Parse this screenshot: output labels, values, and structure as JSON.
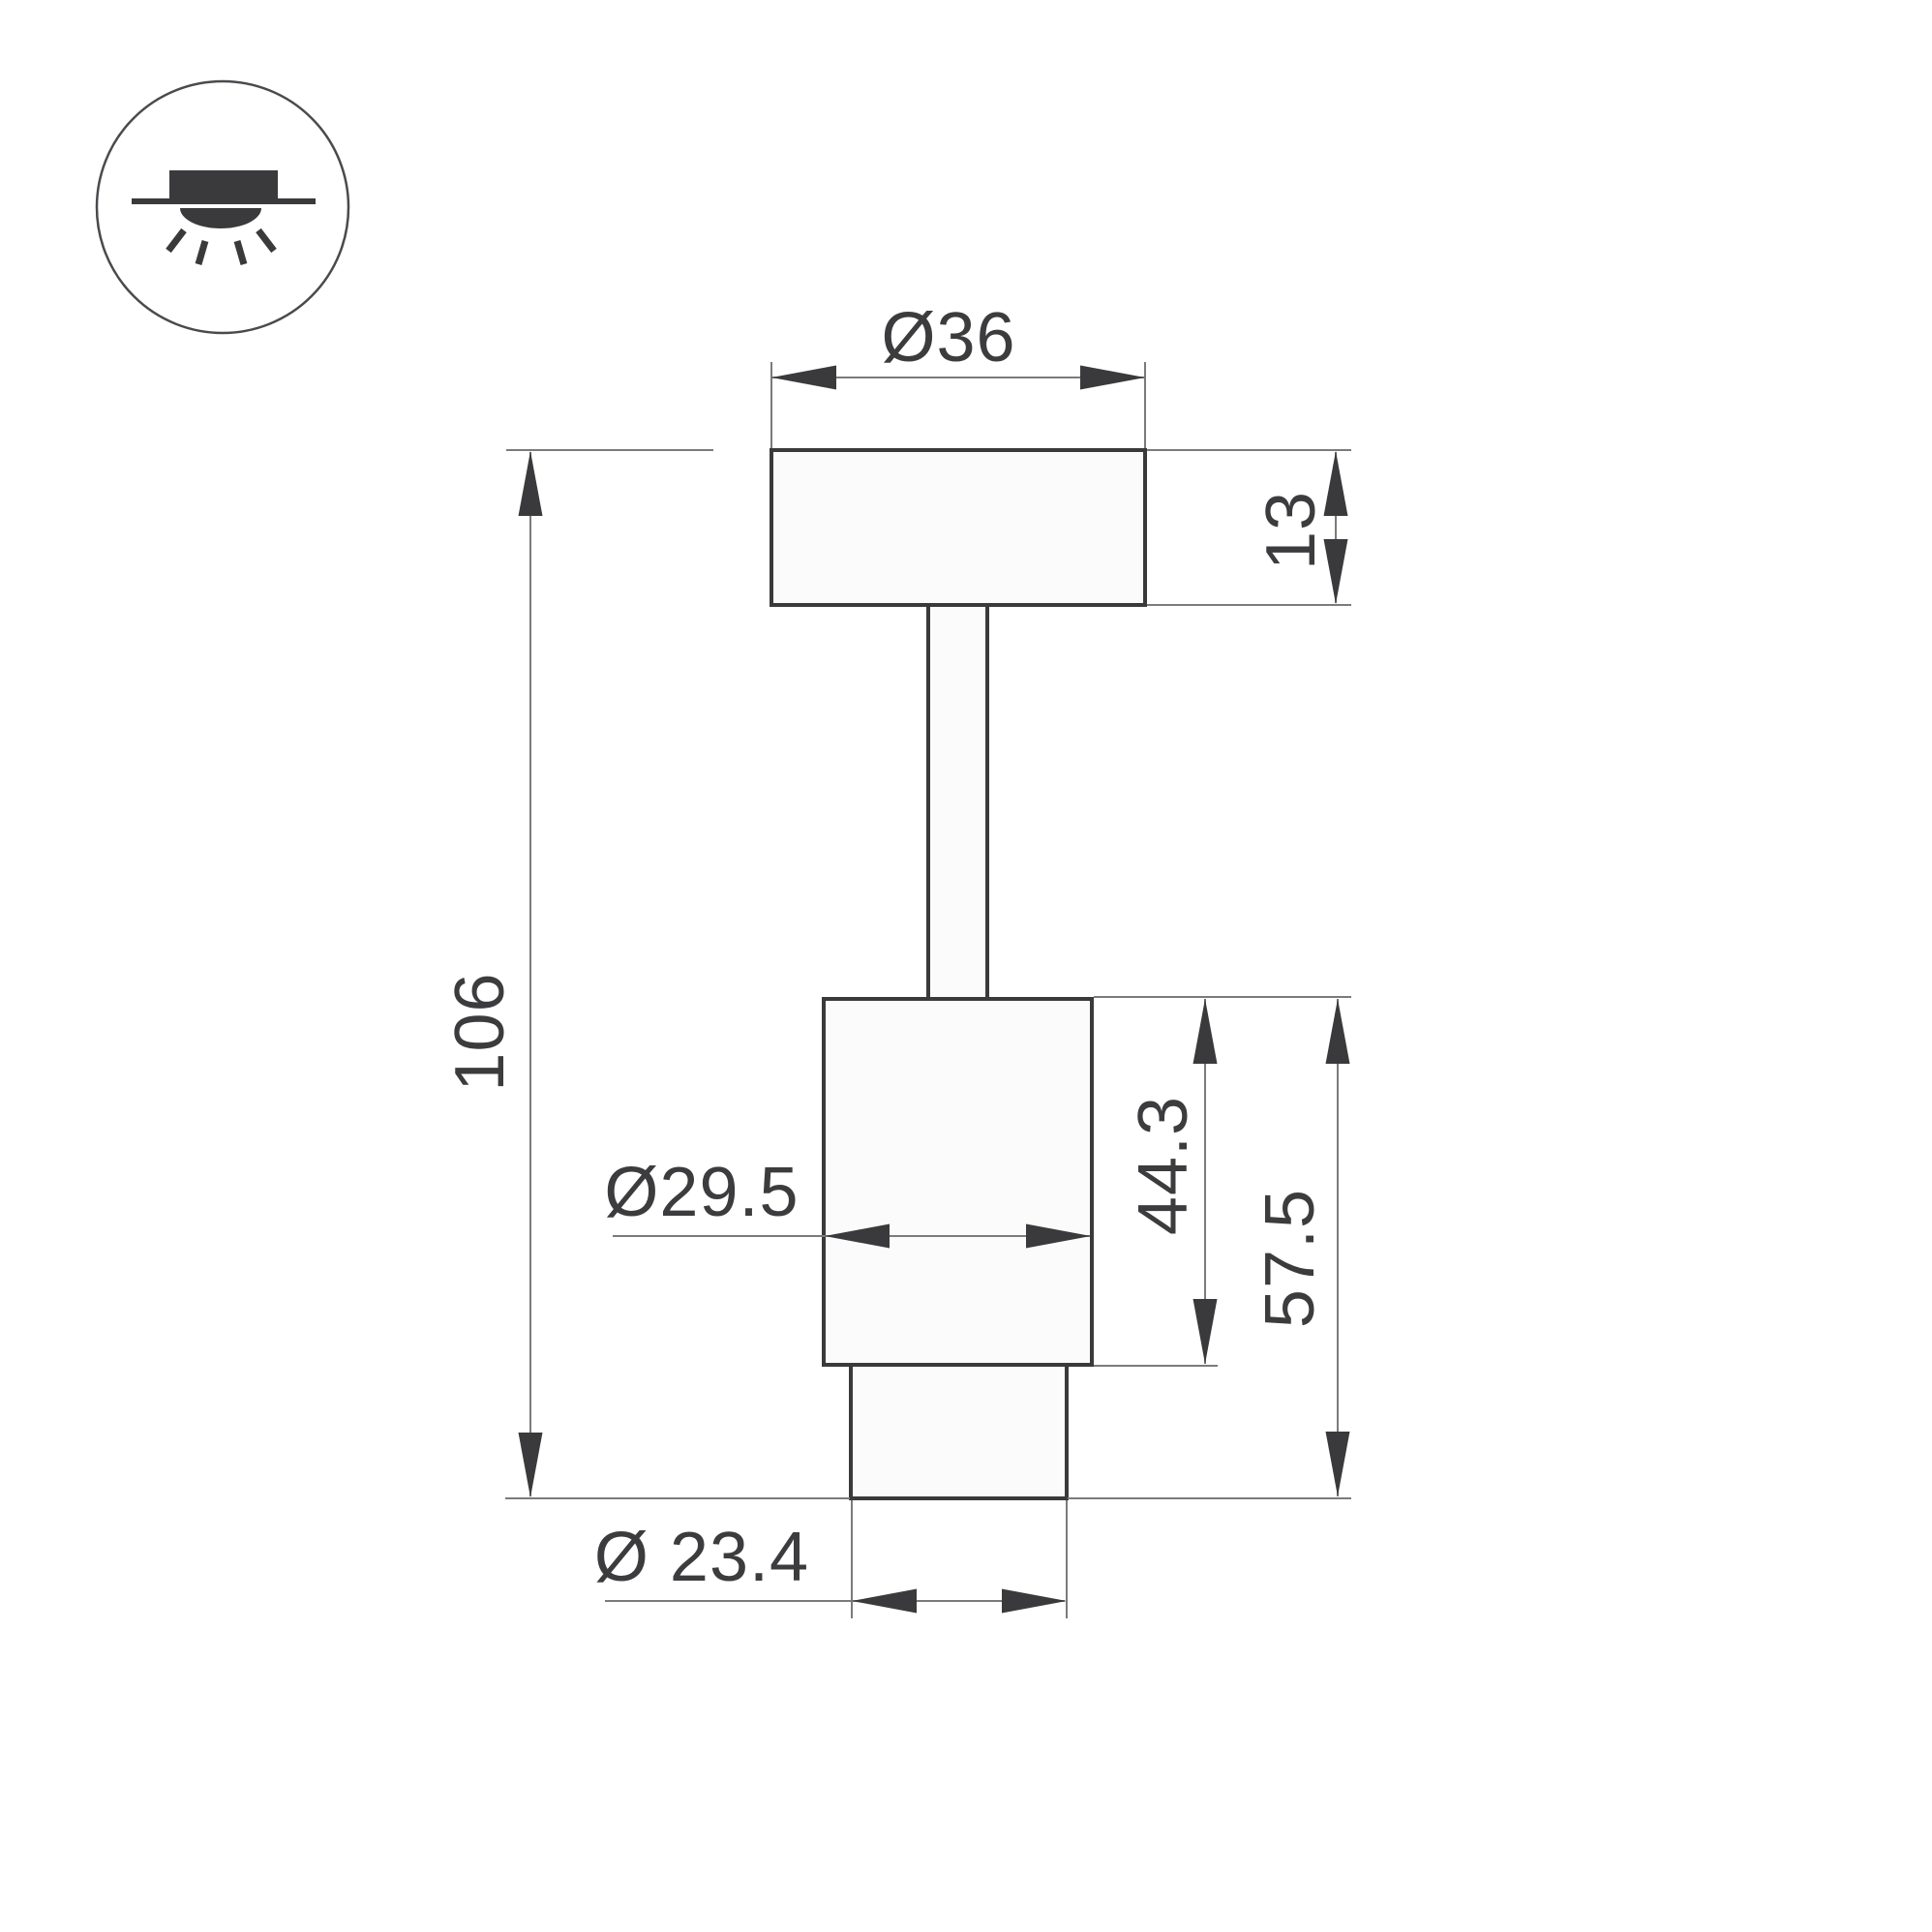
{
  "meta": {
    "background_color": "#ffffff",
    "outline_color": "#3a3a3c",
    "dimension_line_color": "#7b7b7b",
    "shape_fill_color": "#fbfbfb"
  },
  "icon": {
    "name": "surface-mounted-ceiling-light-icon"
  },
  "dimensions": {
    "plate_diameter": "Ø36",
    "plate_height": "13",
    "total_height": "106",
    "body_diameter": "Ø29.5",
    "body_height": "44.3",
    "body_with_nozzle_height": "57.5",
    "nozzle_diameter": "Ø 23.4"
  }
}
